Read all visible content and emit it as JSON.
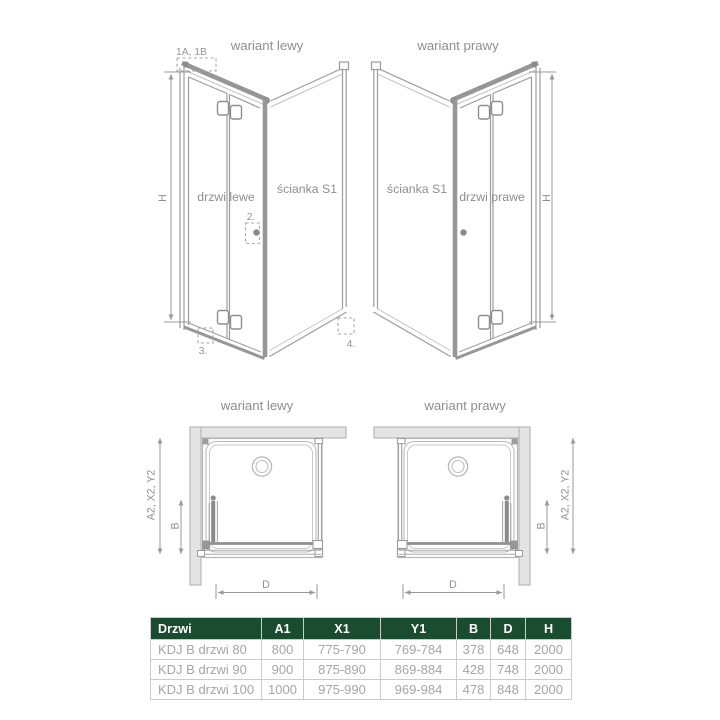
{
  "views": {
    "front_left": {
      "title": "wariant lewy",
      "door_label": "drzwi lewe",
      "wall_label": "ścianka S1",
      "dim_h": "H",
      "callout_top": "1A, 1B",
      "callout_2": "2.",
      "callout_3": "3.",
      "callout_4": "4."
    },
    "front_right": {
      "title": "wariant prawy",
      "door_label": "drzwi prawe",
      "wall_label": "ścianka S1",
      "dim_h": "H"
    },
    "plan_left": {
      "title": "wariant lewy",
      "dim_depth": "A2, X2, Y2",
      "dim_b": "B",
      "dim_d": "D"
    },
    "plan_right": {
      "title": "wariant prawy",
      "dim_depth": "A2, X2, Y2",
      "dim_b": "B",
      "dim_d": "D"
    }
  },
  "table": {
    "headers": [
      "Drzwi",
      "A1",
      "X1",
      "Y1",
      "B",
      "D",
      "H"
    ],
    "rows": [
      [
        "KDJ B drzwi 80",
        "800",
        "775-790",
        "769-784",
        "378",
        "648",
        "2000"
      ],
      [
        "KDJ B drzwi 90",
        "900",
        "875-890",
        "869-884",
        "428",
        "748",
        "2000"
      ],
      [
        "KDJ B drzwi 100",
        "1000",
        "975-990",
        "969-984",
        "478",
        "848",
        "2000"
      ]
    ]
  },
  "colors": {
    "table_header_bg": "#1a4c2f",
    "table_header_text": "#ffffff",
    "table_border": "#cbcbcb",
    "table_body_text": "#a5a5a5",
    "diagram_line": "#9c9c9c",
    "diagram_text": "#8e8e8e",
    "wall_fill": "#e4e4e4"
  }
}
